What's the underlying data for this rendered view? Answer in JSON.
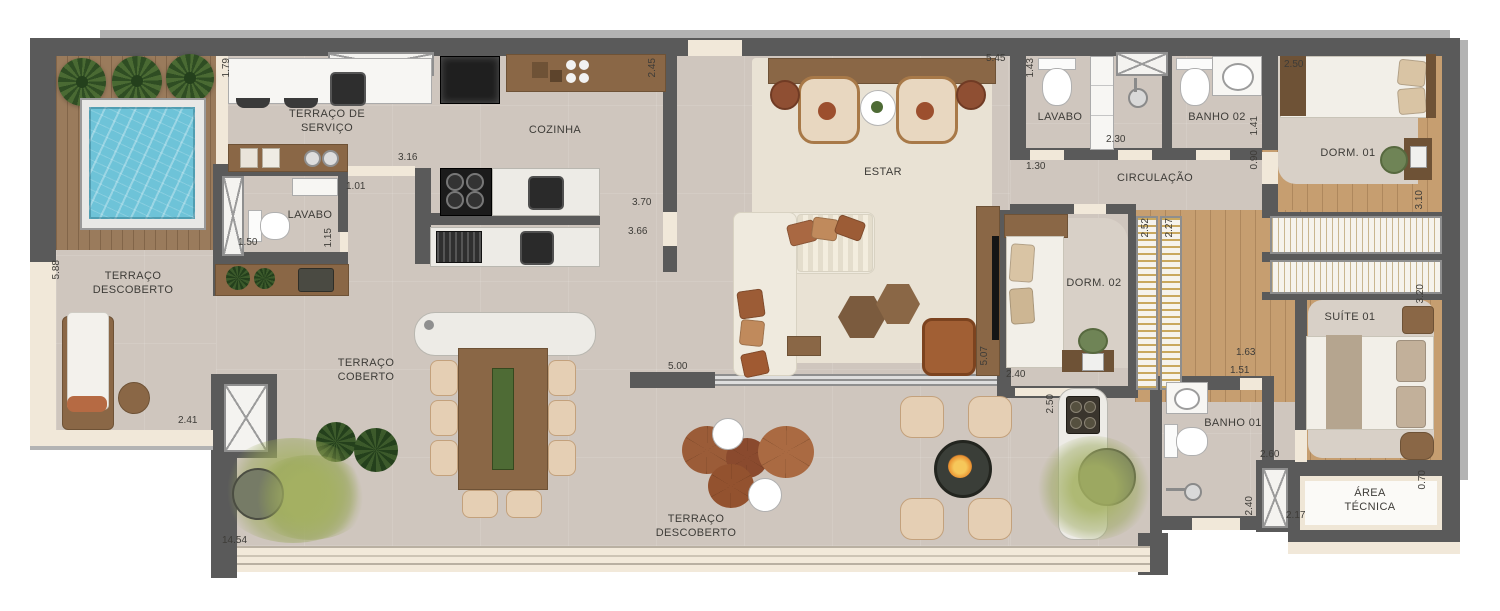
{
  "fp": {
    "rooms": {
      "terraco_descoberto_esq": "TERRAÇO DESCOBERTO",
      "terraco_servico": "TERRAÇO DE SERVIÇO",
      "lavabo_esq": "LAVABO",
      "cozinha": "COZINHA",
      "estar": "ESTAR",
      "lavabo_dir": "LAVABO",
      "banho02": "BANHO 02",
      "circulacao": "CIRCULAÇÃO",
      "dorm01": "DORM. 01",
      "dorm02": "DORM. 02",
      "suite01": "SUÍTE 01",
      "banho01": "BANHO 01",
      "area_tecnica": "ÁREA TÉCNICA",
      "terraco_coberto": "TERRAÇO COBERTO",
      "terraco_descoberto_inf": "TERRAÇO DESCOBERTO"
    },
    "dims": [
      "1.79",
      "3.16",
      "1.01",
      "1.50",
      "1.15",
      "5.88",
      "2.41",
      "14.54",
      "2.45",
      "3.70",
      "3.66",
      "5.00",
      "5.45",
      "1.43",
      "1.30",
      "2.30",
      "1.41",
      "0.90",
      "2.50",
      "3.10",
      "2.52",
      "2.27",
      "2.40",
      "5.07",
      "2.50",
      "1.63",
      "1.51",
      "2.60",
      "3.20",
      "2.40",
      "2.17",
      "0.70"
    ],
    "colors": {
      "wall": "#5a5a5a",
      "floor": "#cfc6be",
      "rug": "#e9e2d4",
      "deck": "#9a7b5c",
      "wood": "#8a6746",
      "wood_floor": "#c69e70",
      "pool": "#6ec3d8",
      "sill": "#f1e8d9",
      "plant": "#3c5a2b",
      "terracotta": "#9b5c38"
    }
  }
}
